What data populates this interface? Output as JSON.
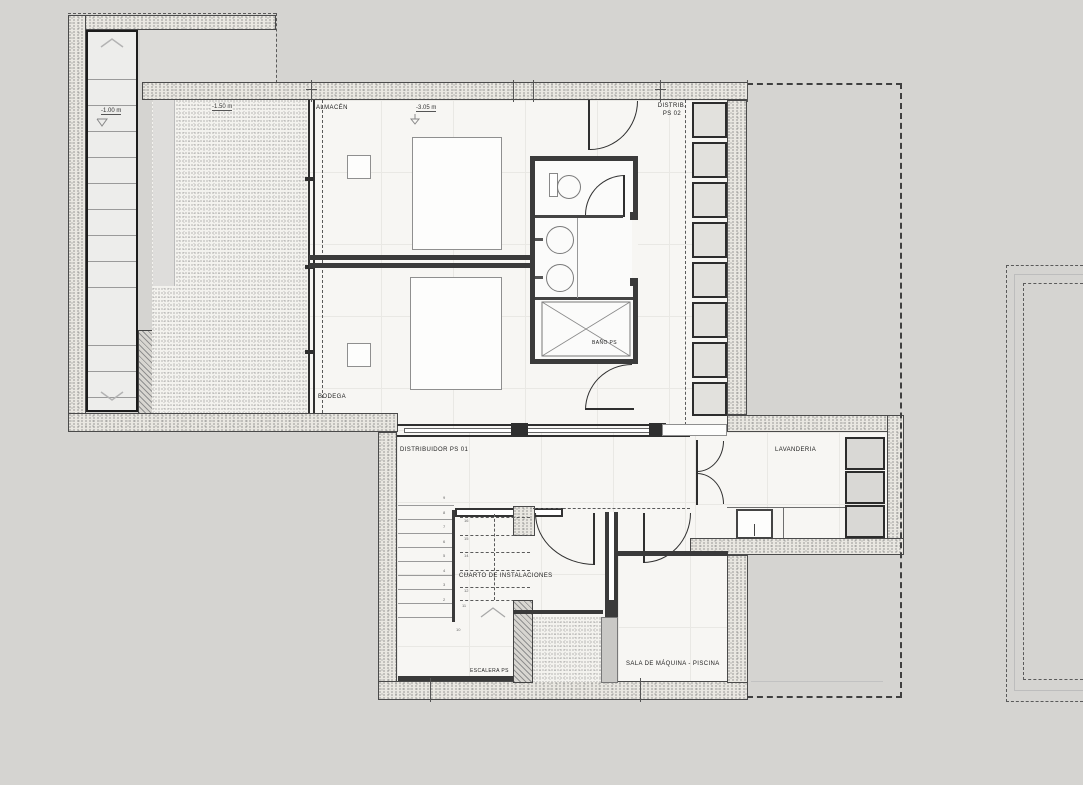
{
  "drawing": {
    "kind": "architectural basement floor plan",
    "background": "#d5d4d1",
    "wall_color": "#3a3a3a",
    "floor_color": "#f7f6f3"
  },
  "rooms": {
    "almacen": "ALMACÉN",
    "bodega": "BODEGA",
    "distrib_ps02_l1": "DISTRIB.",
    "distrib_ps02_l2": "PS 02",
    "bano_ps": "BAÑO PS",
    "distribuidor_ps01": "DISTRIBUIDOR PS 01",
    "lavanderia": "LAVANDERIA",
    "cuarto_instalaciones": "CUARTO DE INSTALACIONES",
    "escalera_ps": "ESCALERA PS",
    "sala_maquina_piscina": "SALA DE MÁQUINA - PISCINA"
  },
  "levels": {
    "exterior_stair": "-1.00 m",
    "courtyard": "-1.50 m",
    "interior": "-3.05 m"
  },
  "stair": {
    "upper": [
      "16",
      "15",
      "14",
      "13",
      "12"
    ],
    "landing": [
      "11",
      "10"
    ],
    "lower": [
      "9",
      "8",
      "7",
      "6",
      "5",
      "4",
      "3",
      "2"
    ]
  }
}
